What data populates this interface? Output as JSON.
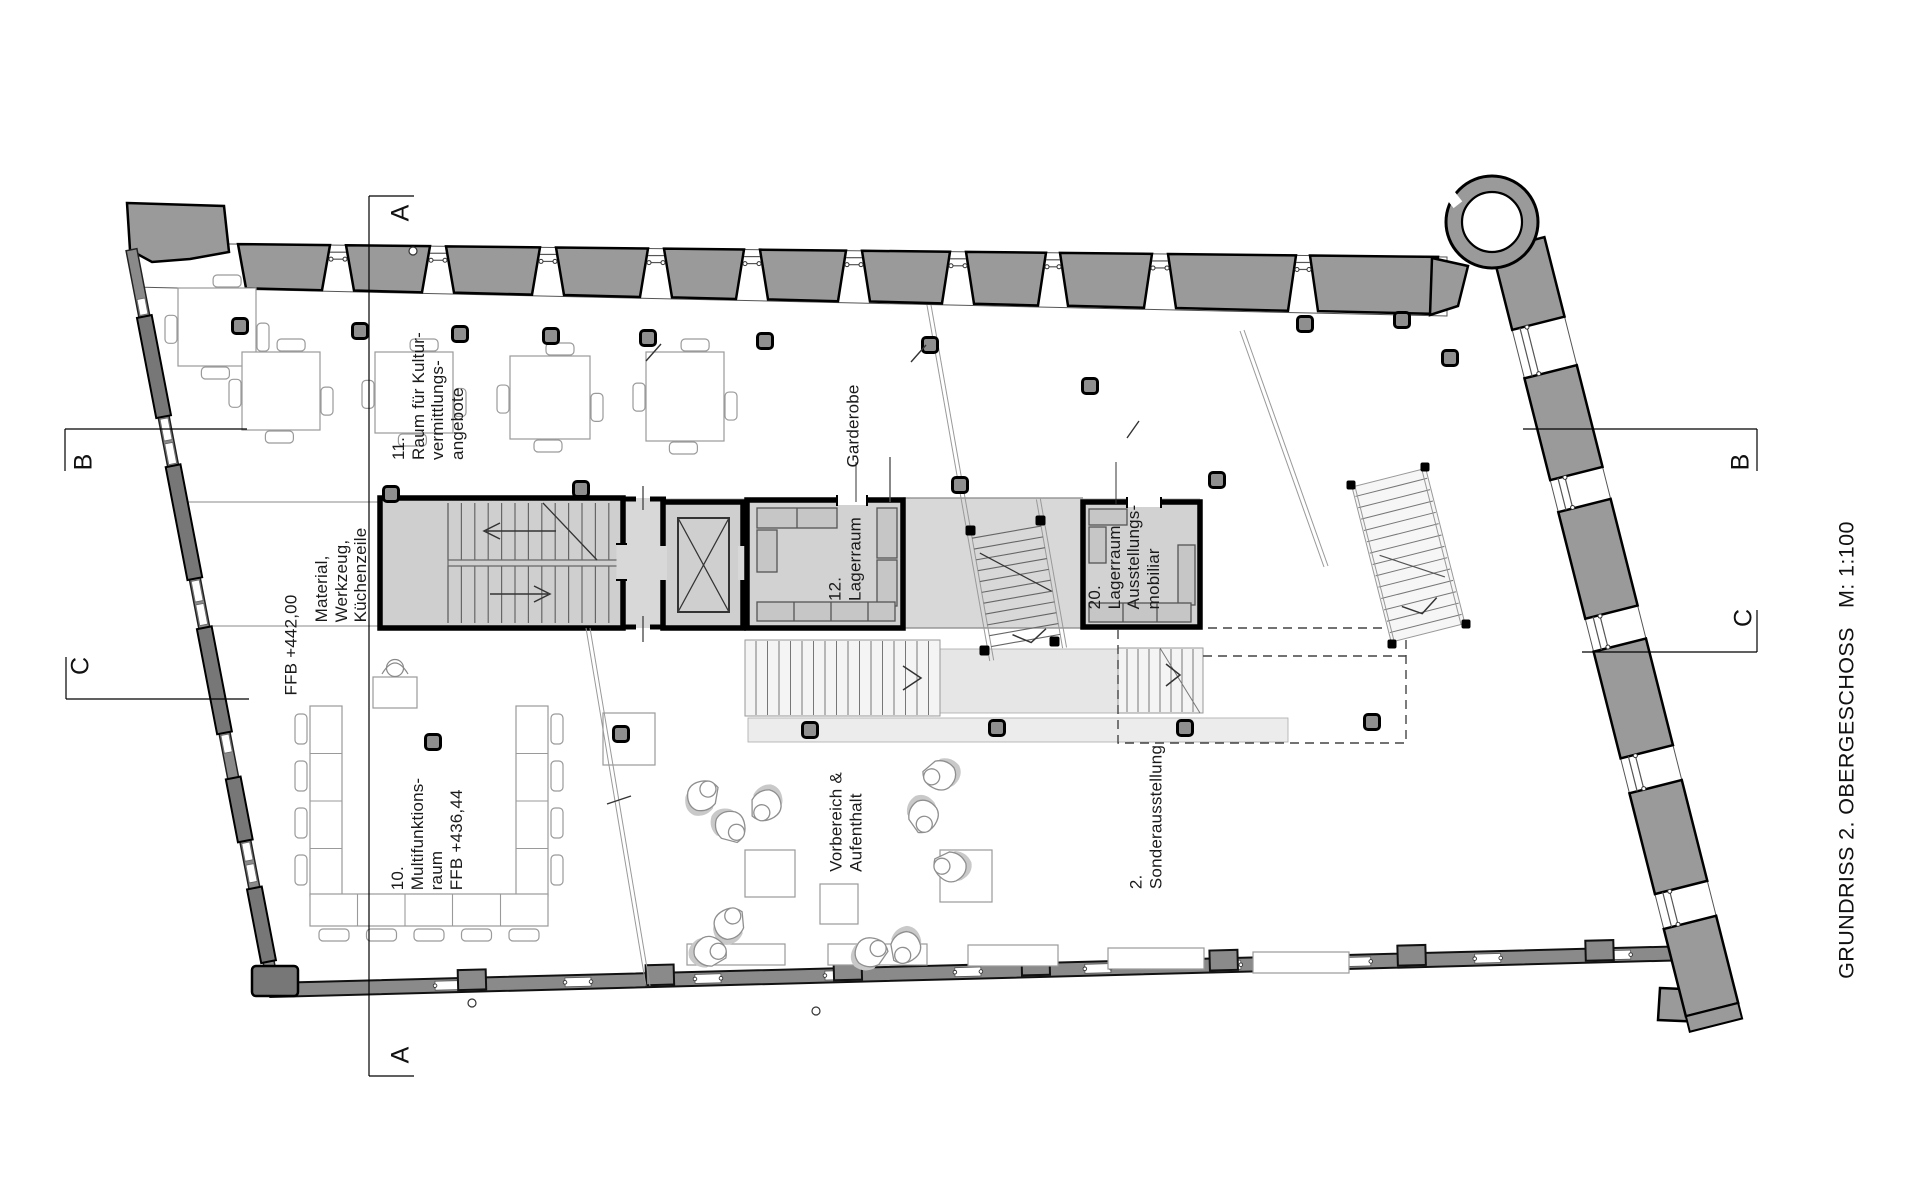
{
  "title": {
    "plan_name": "GRUNDRISS 2. OBERGESCHOSS",
    "scale": "M: 1:100",
    "combined": "GRUNDRISS 2. OBERGESCHOSS   M: 1:100"
  },
  "labels": {
    "room11": "11.\nRaum für Kultur-\nvermittlungs-\nangebote",
    "kitchen": "Material,\nWerkzeug,\nKüchenzeile",
    "level_upper": "FFB +442,00",
    "garderobe": "Garderobe",
    "room12": "12.\nLagerraum",
    "room20": "20.\nLagerraum\nAusstellungs-\nmobiliar",
    "room10": "10.\nMultifunktions-\nraum\nFFB +436,44",
    "vorbereich": "Vorbereich &\nAufenthalt",
    "sonderausstellung": "2.\nSonderausstellung"
  },
  "sections": {
    "a_top": "A",
    "a_bottom": "A",
    "b_left": "B",
    "b_right": "B",
    "c_left": "C",
    "c_right": "C"
  },
  "colors": {
    "pier_fill": "#9a9a9a",
    "band_fill": "#d8d8d8",
    "room_fill": "#d2d2d2",
    "furniture_line": "#9a9a9a",
    "line": "#1a1a1a"
  }
}
